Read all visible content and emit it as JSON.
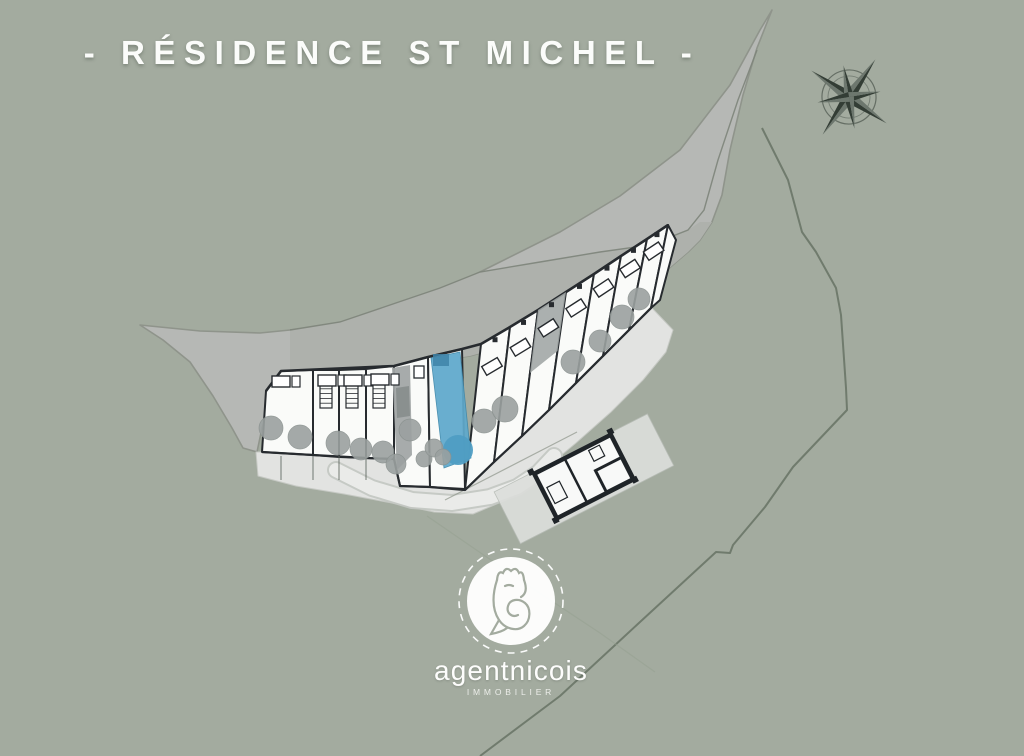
{
  "title": "- RÉSIDENCE ST MICHEL -",
  "logo": {
    "brand": "agentnicois",
    "tagline": "IMMOBILIER"
  },
  "plan": {
    "highlighted_unit": "blue unit with garden strip",
    "compass": "compass-rose"
  },
  "colors": {
    "bg_green": "#a3ab9f",
    "road_gray": "#b6b8b5",
    "slope_gray": "#aeb1ac",
    "boundary": "#707b6d",
    "building_wall": "#272b2f",
    "unit_white": "#fafbf9",
    "terrace": "#e2e3e1",
    "terrace_edge": "#c6c9c4",
    "path_light": "#eaebe9",
    "path_edge": "#c3c6c2",
    "tree_gray": "#9ba1a0",
    "patio_gray": "#a2a7a6",
    "patio_dark": "#8a908f",
    "highlight_blue": "#5fa9cc",
    "highlight_blue_dark": "#4f9dc3",
    "highlight_blue_deep": "#3f84a8",
    "compass_dark": "#333d35",
    "compass_light": "#6d776e",
    "logo_white": "#ffffff"
  }
}
